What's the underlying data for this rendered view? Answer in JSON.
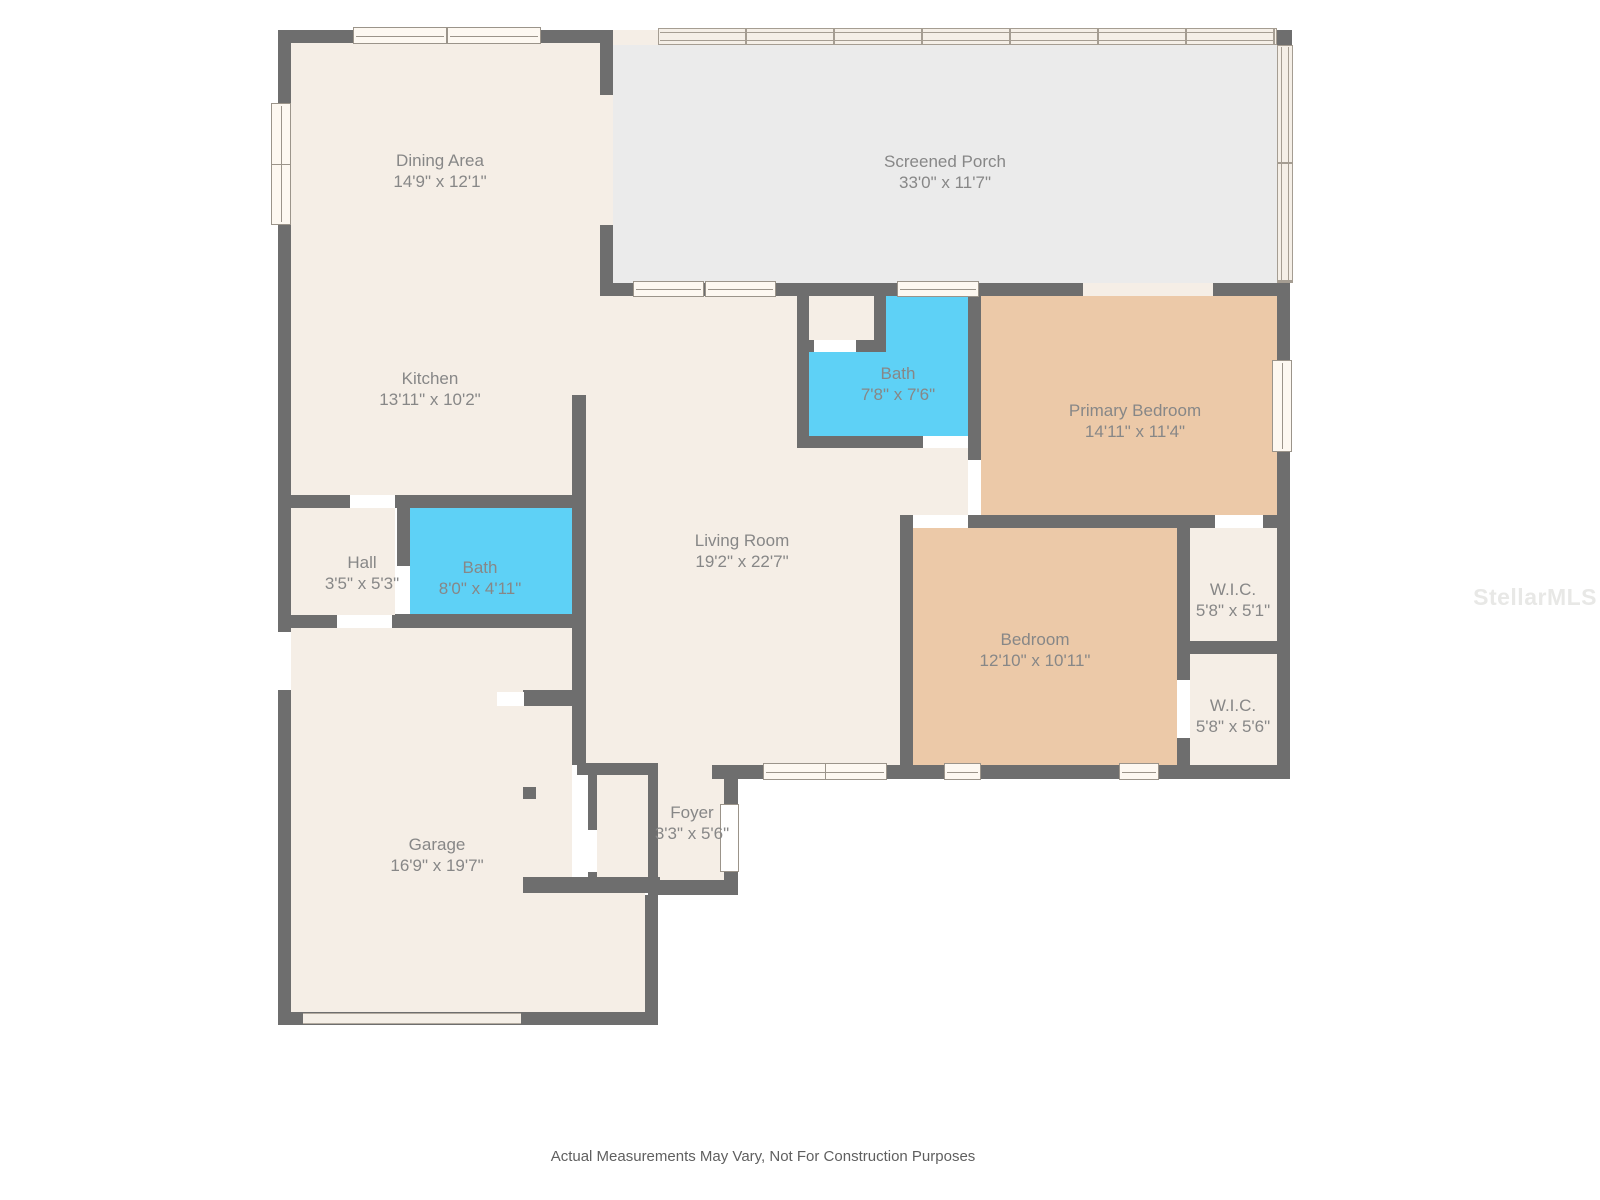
{
  "rooms": [
    {
      "id": "dining",
      "name": "Dining Area",
      "dimensions": "14'9\" x 12'1\""
    },
    {
      "id": "screened-porch",
      "name": "Screened Porch",
      "dimensions": "33'0\" x 11'7\""
    },
    {
      "id": "kitchen",
      "name": "Kitchen",
      "dimensions": "13'11\" x 10'2\""
    },
    {
      "id": "bath-upper",
      "name": "Bath",
      "dimensions": "7'8\" x 7'6\""
    },
    {
      "id": "primary-bedroom",
      "name": "Primary Bedroom",
      "dimensions": "14'11\" x 11'4\""
    },
    {
      "id": "hall",
      "name": "Hall",
      "dimensions": "3'5\" x 5'3\""
    },
    {
      "id": "bath-lower",
      "name": "Bath",
      "dimensions": "8'0\" x 4'11\""
    },
    {
      "id": "living-room",
      "name": "Living Room",
      "dimensions": "19'2\" x 22'7\""
    },
    {
      "id": "wic-upper",
      "name": "W.I.C.",
      "dimensions": "5'8\" x 5'1\""
    },
    {
      "id": "bedroom",
      "name": "Bedroom",
      "dimensions": "12'10\" x 10'11\""
    },
    {
      "id": "wic-lower",
      "name": "W.I.C.",
      "dimensions": "5'8\" x 5'6\""
    },
    {
      "id": "garage",
      "name": "Garage",
      "dimensions": "16'9\" x 19'7\""
    },
    {
      "id": "foyer",
      "name": "Foyer",
      "dimensions": "3'3\" x 5'6\""
    }
  ],
  "watermark": "StellarMLS",
  "disclaimer": "Actual Measurements May Vary, Not For Construction Purposes",
  "colors": {
    "wall": "#6e6e6e",
    "floor": "#f5eee6",
    "porch_floor": "#ebebeb",
    "bedroom_floor": "#ecc9a8",
    "bath_floor": "#5ed1f6",
    "label_text": "#878787",
    "disclaimer_text": "#5f5f5f",
    "watermark_text": "#e8e8e6"
  }
}
